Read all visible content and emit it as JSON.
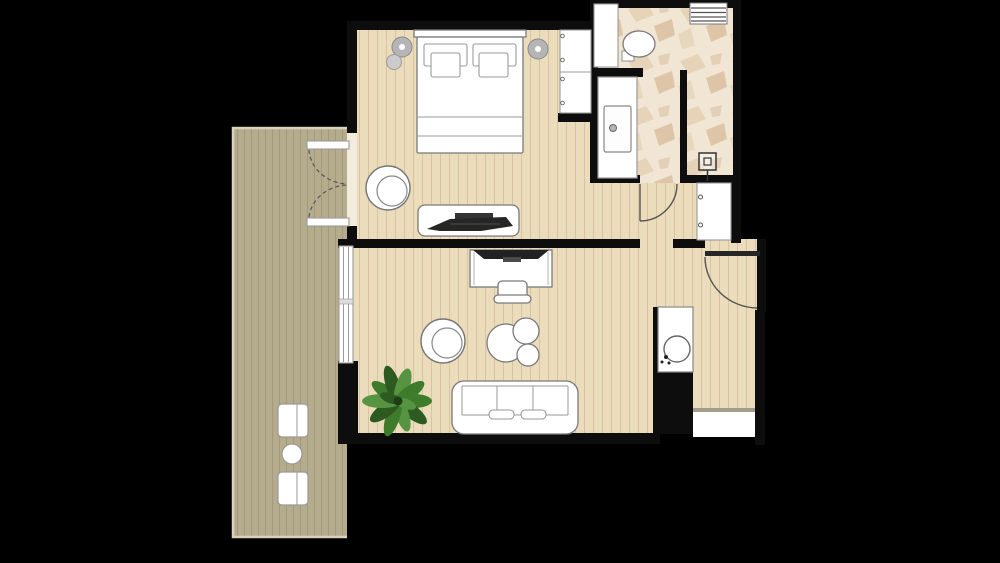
{
  "scene": {
    "type": "apartment-floor-plan",
    "description": "top-down architectural floor plan of a hotel-style suite on black background",
    "visible_text": []
  },
  "palette": {
    "background": "#000000",
    "wall": "#0d0d0d",
    "floor_wood": "#ebdcbb",
    "floor_wood_line": "#d8c4a0",
    "balcony_wood": "#b5ab8d",
    "balcony_wood_line": "#a3997b",
    "balcony_edge": "#dcd6c4",
    "marble_base": "#f0e6d3",
    "marble_vein_light": "#e0c9a9",
    "marble_vein_dark": "#c79e74",
    "furniture_fill": "#ffffff",
    "furniture_stroke": "#7a7a7a",
    "soft_stroke": "#9a9a9a",
    "dark_equipment": "#222222",
    "lamp_gray": "#b5b5b5",
    "plant_dark": "#2d5a20",
    "plant_mid": "#3e7b2b",
    "plant_light": "#579441",
    "door_arc": "#555555",
    "threshold_white": "#f2ecdc",
    "niche_edge": "#a59d8c"
  },
  "rooms": [
    {
      "name": "bedroom",
      "floor": "light-wood-planks",
      "furniture": [
        "double-bed",
        "two-pillows",
        "bedside-lamp-left",
        "bedside-lamp-right",
        "tub-chair",
        "tv-console",
        "television",
        "wardrobe"
      ]
    },
    {
      "name": "bathroom",
      "floor": "marble-stone",
      "furniture": [
        "toilet",
        "vanity-with-sink",
        "shower-drain",
        "towel-radiator",
        "service-shaft"
      ]
    },
    {
      "name": "hallway",
      "floor": "light-wood-planks",
      "furniture": [
        "closet"
      ]
    },
    {
      "name": "living-room",
      "floor": "light-wood-planks",
      "furniture": [
        "desk",
        "desk-monitor",
        "desk-chair",
        "round-armchair",
        "coffee-table-set-3",
        "three-seat-sofa",
        "potted-plant"
      ]
    },
    {
      "name": "entry",
      "floor": "light-wood-planks",
      "furniture": [
        "washbasin-counter",
        "storage-niche"
      ]
    },
    {
      "name": "balcony",
      "floor": "dark-wood-decking",
      "furniture": [
        "outdoor-chair-top",
        "outdoor-side-table",
        "outdoor-chair-bottom"
      ]
    }
  ],
  "doors": [
    "balcony-french-doors-double-swing",
    "bathroom-door-swing",
    "entry-door-swing"
  ],
  "windows": [
    "living-room-window"
  ]
}
